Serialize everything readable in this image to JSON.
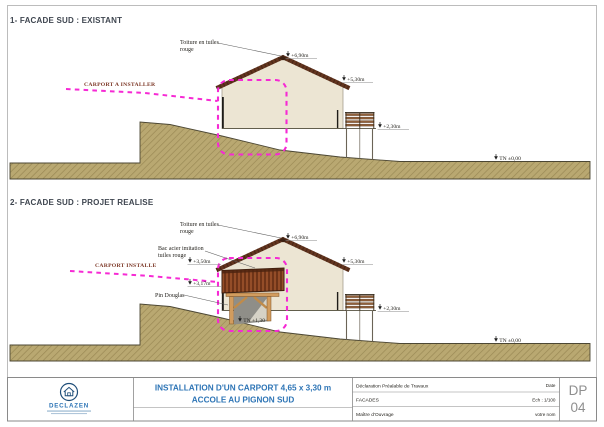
{
  "sheet": {
    "sections": {
      "existant": {
        "heading": "1- FACADE SUD : EXISTANT"
      },
      "projet": {
        "heading": "2- FACADE SUD : PROJET REALISE"
      }
    },
    "annotations": {
      "toiture_line1": "Toiture en tuiles",
      "toiture_line2": "rouge",
      "bac_line1": "Bac acier imitation",
      "bac_line2": "tuiles rouge",
      "carport_existant": "CARPORT A INSTALLER",
      "carport_projet": "CARPORT INSTALLE",
      "pin_douglas": "Pin Douglas"
    },
    "levels": {
      "ridge": "+6,90m",
      "eave": "+5,30m",
      "terrace": "+2,30m",
      "tn_zero": "TN ±0,00",
      "carport_top": "+3,50m",
      "carport_under": "+3,17m",
      "tn_carport": "TN +1,30"
    }
  },
  "title_block": {
    "logo_name": "DECLAZEN",
    "project_title_line1": "INSTALLATION D'UN CARPORT 4,65 x 3,30 m",
    "project_title_line2": "ACCOLE AU PIGNON SUD",
    "rows": [
      {
        "label": "Déclaration Préalable de Travaux",
        "value": "Date"
      },
      {
        "label": "FACADES",
        "value": "Ech : 1/100"
      },
      {
        "label": "Maître d'Ouvrage",
        "value": "votre nom"
      }
    ],
    "sheet_code_line1": "DP",
    "sheet_code_line2": "04"
  },
  "colors": {
    "magenta": "#f62ad4",
    "wall": "#ece5d3",
    "roof": "#63351f",
    "ground": "#b9a871",
    "wood": "#d29c5e",
    "bac_acier": "#8a4423",
    "title_blue": "#2e75b6"
  }
}
